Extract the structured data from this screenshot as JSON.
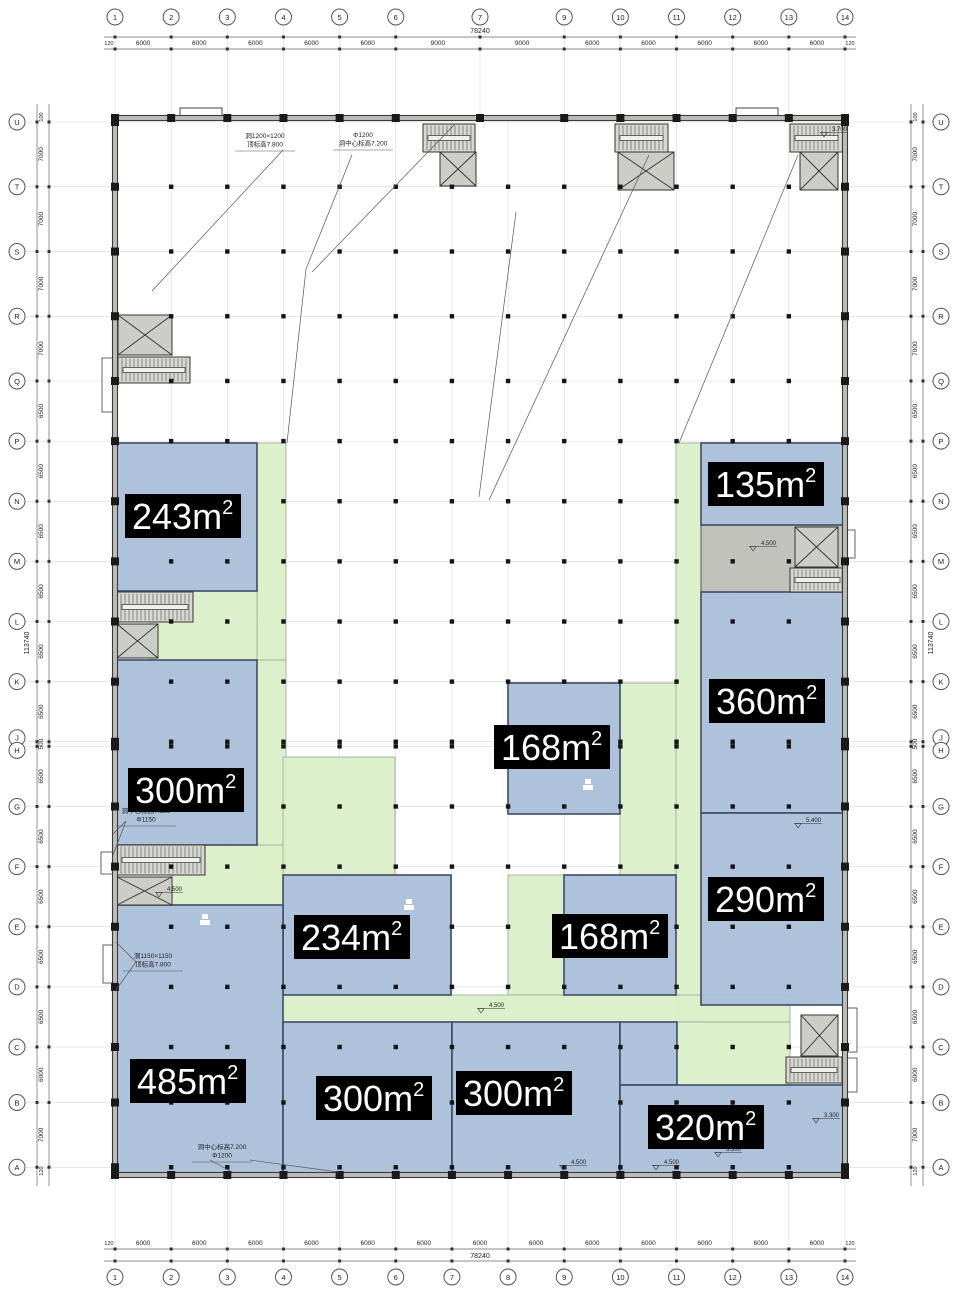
{
  "drawing": {
    "type": "floor-plan",
    "colors": {
      "room_fill": "#a9bdd8",
      "room_border": "#3e4d63",
      "corridor_fill": "#daefc8",
      "corridor_border": "#9aa892",
      "service_fill": "#bfbfb9",
      "wall": "#3a3a3a",
      "wall_band": "#bdbdb8",
      "grid": "#9c9c9c",
      "dot": "#151515",
      "label_bg": "#000000",
      "label_text": "#ffffff",
      "stair_fill": "#d8d8d2",
      "shaft_fill": "#cccdc7",
      "dim": "#666666"
    }
  },
  "axes": {
    "top": {
      "bubbles": [
        "1",
        "2",
        "3",
        "4",
        "5",
        "6",
        "7",
        "9",
        "10",
        "11",
        "12",
        "13",
        "14"
      ],
      "spacings_mm": [
        0,
        6000,
        6000,
        6000,
        6000,
        6000,
        9000,
        9000,
        6000,
        6000,
        6000,
        6000,
        6000
      ],
      "segment_dims": [
        "6000",
        "6000",
        "6000",
        "6000",
        "6000",
        "9000",
        "9000",
        "6000",
        "6000",
        "6000",
        "6000",
        "6000"
      ],
      "edge_dims": [
        "120",
        "120"
      ],
      "total_dim": "78240"
    },
    "bottom": {
      "bubbles": [
        "1",
        "2",
        "3",
        "4",
        "5",
        "6",
        "7",
        "8",
        "9",
        "10",
        "11",
        "12",
        "13",
        "14"
      ],
      "spacings_mm": [
        0,
        6000,
        6000,
        6000,
        6000,
        6000,
        6000,
        6000,
        6000,
        6000,
        6000,
        6000,
        6000,
        6000
      ],
      "segment_dims": [
        "6000",
        "6000",
        "6000",
        "6000",
        "6000",
        "6000",
        "6000",
        "6000",
        "6000",
        "6000",
        "6000",
        "6000",
        "6000"
      ],
      "edge_dims": [
        "120",
        "120"
      ],
      "total_dim": "78240"
    },
    "left": {
      "bubbles": [
        "U",
        "T",
        "S",
        "R",
        "Q",
        "P",
        "N",
        "M",
        "L",
        "K",
        "J",
        "H",
        "G",
        "F",
        "E",
        "D",
        "C",
        "B",
        "A"
      ],
      "spacings_mm": [
        0,
        7000,
        7000,
        7000,
        7000,
        6500,
        6500,
        6500,
        6500,
        6500,
        6500,
        500,
        6500,
        6500,
        6500,
        6500,
        6500,
        6000,
        7000
      ],
      "segment_dims": [
        "7000",
        "7000",
        "7000",
        "7000",
        "6500",
        "6500",
        "6500",
        "6500",
        "6500",
        "6500",
        "500",
        "6500",
        "6500",
        "6500",
        "6500",
        "6500",
        "6000",
        "7000"
      ],
      "edge_dims": [
        "100",
        "120"
      ],
      "total_dim": "113740"
    },
    "right": {
      "bubbles": [
        "U",
        "T",
        "S",
        "R",
        "Q",
        "P",
        "N",
        "M",
        "L",
        "K",
        "J",
        "H",
        "G",
        "F",
        "E",
        "D",
        "C",
        "B",
        "A"
      ],
      "spacings_mm": [
        0,
        7000,
        7000,
        7000,
        7000,
        6500,
        6500,
        6500,
        6500,
        6500,
        6500,
        500,
        6500,
        6500,
        6500,
        6500,
        6500,
        6000,
        7000
      ],
      "segment_dims": [
        "7000",
        "7000",
        "7000",
        "7000",
        "6500",
        "6500",
        "6500",
        "6500",
        "6500",
        "6500",
        "500",
        "6500",
        "6500",
        "6500",
        "6500",
        "6500",
        "6000",
        "7000"
      ],
      "edge_dims": [
        "100",
        "120"
      ],
      "total_dim": "113740"
    }
  },
  "rooms": [
    {
      "value": "243",
      "unit": "m",
      "sup": "2",
      "box": [
        115,
        443,
        142,
        148
      ],
      "label_pos": [
        183,
        516
      ]
    },
    {
      "value": "135",
      "unit": "m",
      "sup": "2",
      "box": [
        701,
        443,
        144,
        82
      ],
      "label_pos": [
        766,
        484
      ]
    },
    {
      "value": "360",
      "unit": "m",
      "sup": "2",
      "box": [
        701,
        592,
        144,
        221
      ],
      "label_pos": [
        767,
        701
      ]
    },
    {
      "value": "300",
      "unit": "m",
      "sup": "2",
      "box": [
        115,
        660,
        142,
        185
      ],
      "label_pos": [
        186,
        790
      ]
    },
    {
      "value": "168",
      "unit": "m",
      "sup": "2",
      "box": [
        508,
        683,
        112,
        131
      ],
      "label_pos": [
        552,
        747
      ]
    },
    {
      "value": "234",
      "unit": "m",
      "sup": "2",
      "box": [
        283,
        875,
        168,
        120
      ],
      "label_pos": [
        352,
        937
      ]
    },
    {
      "value": "168",
      "unit": "m",
      "sup": "2",
      "box": [
        564,
        875,
        112,
        120
      ],
      "label_pos": [
        610,
        936
      ]
    },
    {
      "value": "290",
      "unit": "m",
      "sup": "2",
      "box": [
        701,
        813,
        144,
        192
      ],
      "label_pos": [
        766,
        899
      ]
    },
    {
      "value": "485",
      "unit": "m",
      "sup": "2",
      "box": [
        115,
        905,
        168,
        270
      ],
      "label_pos": [
        188,
        1081
      ]
    },
    {
      "value": "300",
      "unit": "m",
      "sup": "2",
      "box": [
        283,
        1022,
        169,
        153
      ],
      "label_pos": [
        374,
        1098
      ]
    },
    {
      "value": "300",
      "unit": "m",
      "sup": "2",
      "box": [
        452,
        1022,
        168,
        153
      ],
      "label_pos": [
        514,
        1093
      ]
    },
    {
      "value": null,
      "unit": null,
      "sup": null,
      "box": [
        620,
        1022,
        57,
        63
      ],
      "label_pos": null
    },
    {
      "value": "320",
      "unit": "m",
      "sup": "2",
      "box": [
        620,
        1085,
        225,
        90
      ],
      "label_pos": [
        706,
        1127
      ]
    }
  ],
  "corridors": [
    [
      257,
      443,
      29,
      217
    ],
    [
      150,
      591,
      107,
      69
    ],
    [
      257,
      660,
      29,
      215
    ],
    [
      172,
      845,
      113,
      60
    ],
    [
      283,
      757,
      112,
      118
    ],
    [
      508,
      875,
      56,
      120
    ],
    [
      620,
      683,
      57,
      192
    ],
    [
      676,
      443,
      25,
      579
    ],
    [
      283,
      995,
      507,
      27
    ],
    [
      676,
      1022,
      114,
      63
    ]
  ],
  "service_zones": [
    [
      701,
      525,
      144,
      67
    ]
  ],
  "stairs": [
    [
      423,
      124,
      52,
      28
    ],
    [
      615,
      124,
      53,
      28
    ],
    [
      790,
      124,
      53,
      28
    ],
    [
      118,
      357,
      72,
      26
    ],
    [
      117,
      592,
      76,
      30
    ],
    [
      117,
      845,
      88,
      30
    ],
    [
      790,
      568,
      55,
      24
    ],
    [
      786,
      1057,
      56,
      26
    ]
  ],
  "shafts": [
    [
      440,
      152,
      36,
      34
    ],
    [
      618,
      152,
      56,
      38
    ],
    [
      800,
      152,
      38,
      38
    ],
    [
      118,
      315,
      54,
      40
    ],
    [
      117,
      624,
      41,
      34
    ],
    [
      117,
      877,
      55,
      28
    ],
    [
      795,
      527,
      43,
      40
    ],
    [
      801,
      1015,
      37,
      41
    ]
  ],
  "fixtures": [
    [
      102,
      358,
      13,
      54
    ],
    [
      101,
      852,
      13,
      22
    ],
    [
      103,
      945,
      13,
      38
    ],
    [
      846,
      1008,
      11,
      44
    ],
    [
      846,
      1058,
      11,
      34
    ],
    [
      845,
      530,
      10,
      28
    ]
  ],
  "canopies": [
    [
      180,
      108,
      42,
      10
    ],
    [
      736,
      108,
      42,
      10
    ]
  ],
  "leaders": [
    [
      283,
      150,
      152,
      291
    ],
    [
      352,
      155,
      306,
      269
    ],
    [
      306,
      269,
      287,
      443
    ],
    [
      455,
      124,
      312,
      272
    ],
    [
      516,
      212,
      479,
      497
    ],
    [
      649,
      155,
      489,
      500
    ],
    [
      798,
      155,
      679,
      443
    ],
    [
      126,
      821,
      113,
      834
    ],
    [
      126,
      821,
      113,
      855
    ],
    [
      136,
      962,
      116,
      942
    ],
    [
      136,
      962,
      116,
      990
    ],
    [
      210,
      1160,
      232,
      1172
    ],
    [
      250,
      1160,
      338,
      1172
    ]
  ],
  "annotations": [
    {
      "lines": [
        "洞1200×1200",
        "顶标高7.800"
      ],
      "pos": [
        265,
        138
      ]
    },
    {
      "lines": [
        "Φ1200",
        "洞中心标高7.200"
      ],
      "pos": [
        363,
        137
      ]
    },
    {
      "lines": [
        "洞中心标高7.225",
        "Φ1150"
      ],
      "pos": [
        146,
        813
      ]
    },
    {
      "lines": [
        "洞1150×1150",
        "顶标高7.800"
      ],
      "pos": [
        153,
        958
      ]
    },
    {
      "lines": [
        "洞中心标高7.200",
        "Φ1200"
      ],
      "pos": [
        222,
        1149
      ]
    }
  ],
  "level_markers": [
    {
      "value": "3.700",
      "pos": [
        828,
        131
      ]
    },
    {
      "value": "4.500",
      "pos": [
        757,
        545
      ]
    },
    {
      "value": "5.400",
      "pos": [
        802,
        822
      ]
    },
    {
      "value": "4.500",
      "pos": [
        163,
        891
      ]
    },
    {
      "value": "4.500",
      "pos": [
        485,
        1007
      ]
    },
    {
      "value": "3.300",
      "pos": [
        820,
        1117
      ]
    },
    {
      "value": "4.500",
      "pos": [
        567,
        1164
      ]
    },
    {
      "value": "4.500",
      "pos": [
        660,
        1164
      ]
    },
    {
      "value": "3.300",
      "pos": [
        722,
        1151
      ]
    }
  ],
  "icons": [
    [
      583,
      779
    ],
    [
      404,
      899
    ],
    [
      200,
      914
    ]
  ]
}
